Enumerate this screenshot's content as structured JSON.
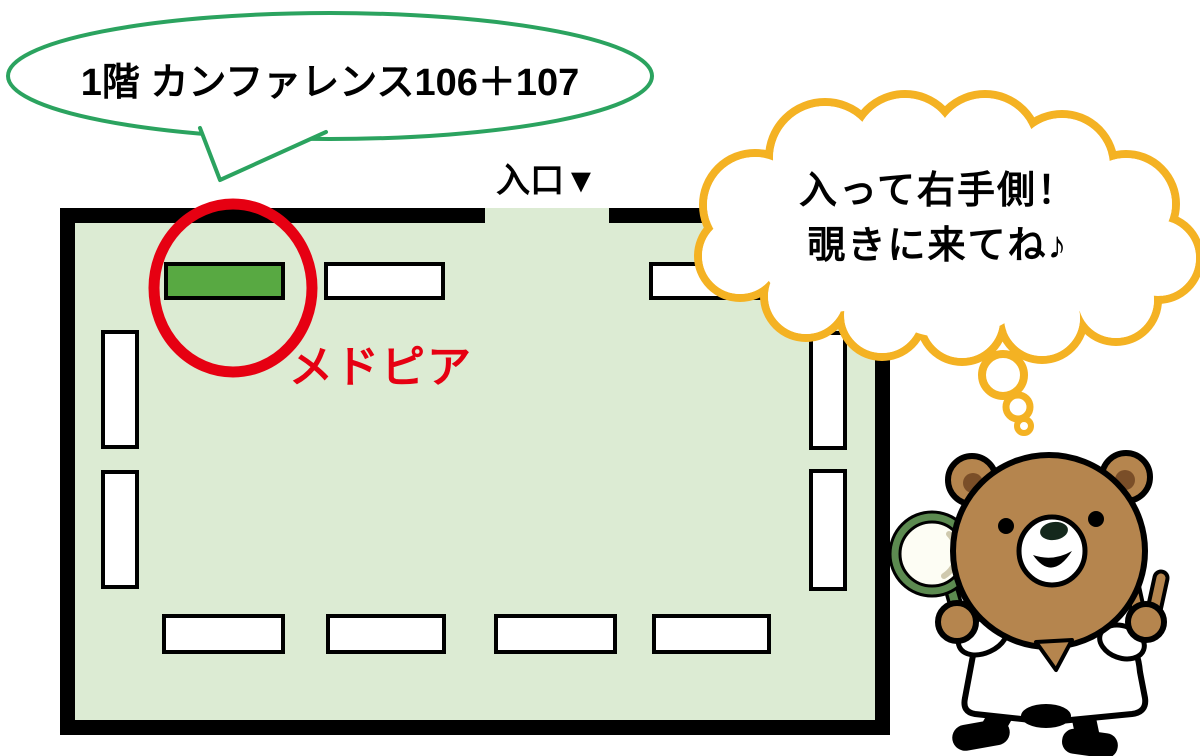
{
  "title_bubble": {
    "label": "1階 カンファレンス106＋107"
  },
  "entrance": {
    "label": "入口▼"
  },
  "map": {
    "highlight_label": "メドピア",
    "highlight_booth": {
      "x": 166,
      "y": 264,
      "w": 117,
      "h": 34
    },
    "booths": [
      {
        "x": 326,
        "y": 264,
        "w": 117,
        "h": 34
      },
      {
        "x": 651,
        "y": 264,
        "w": 117,
        "h": 34
      },
      {
        "x": 103,
        "y": 332,
        "w": 34,
        "h": 115
      },
      {
        "x": 103,
        "y": 472,
        "w": 34,
        "h": 115
      },
      {
        "x": 811,
        "y": 333,
        "w": 34,
        "h": 115
      },
      {
        "x": 811,
        "y": 471,
        "w": 34,
        "h": 118
      },
      {
        "x": 164,
        "y": 616,
        "w": 119,
        "h": 36
      },
      {
        "x": 328,
        "y": 616,
        "w": 116,
        "h": 36
      },
      {
        "x": 496,
        "y": 616,
        "w": 119,
        "h": 36
      },
      {
        "x": 654,
        "y": 616,
        "w": 115,
        "h": 36
      }
    ]
  },
  "thought_bubble": {
    "line1": "入って右手側！",
    "line2": "覗きに来てね♪"
  },
  "colors": {
    "floor_green": "#dcebd3",
    "booth_green": "#58a942",
    "highlight_red": "#e60012",
    "cloud_yellow": "#f4b223",
    "bubble_green": "#2ba35f",
    "bear_brown": "#b5854e",
    "bear_ear_inner": "#7a4e28",
    "glass_green": "#5c8a50"
  }
}
